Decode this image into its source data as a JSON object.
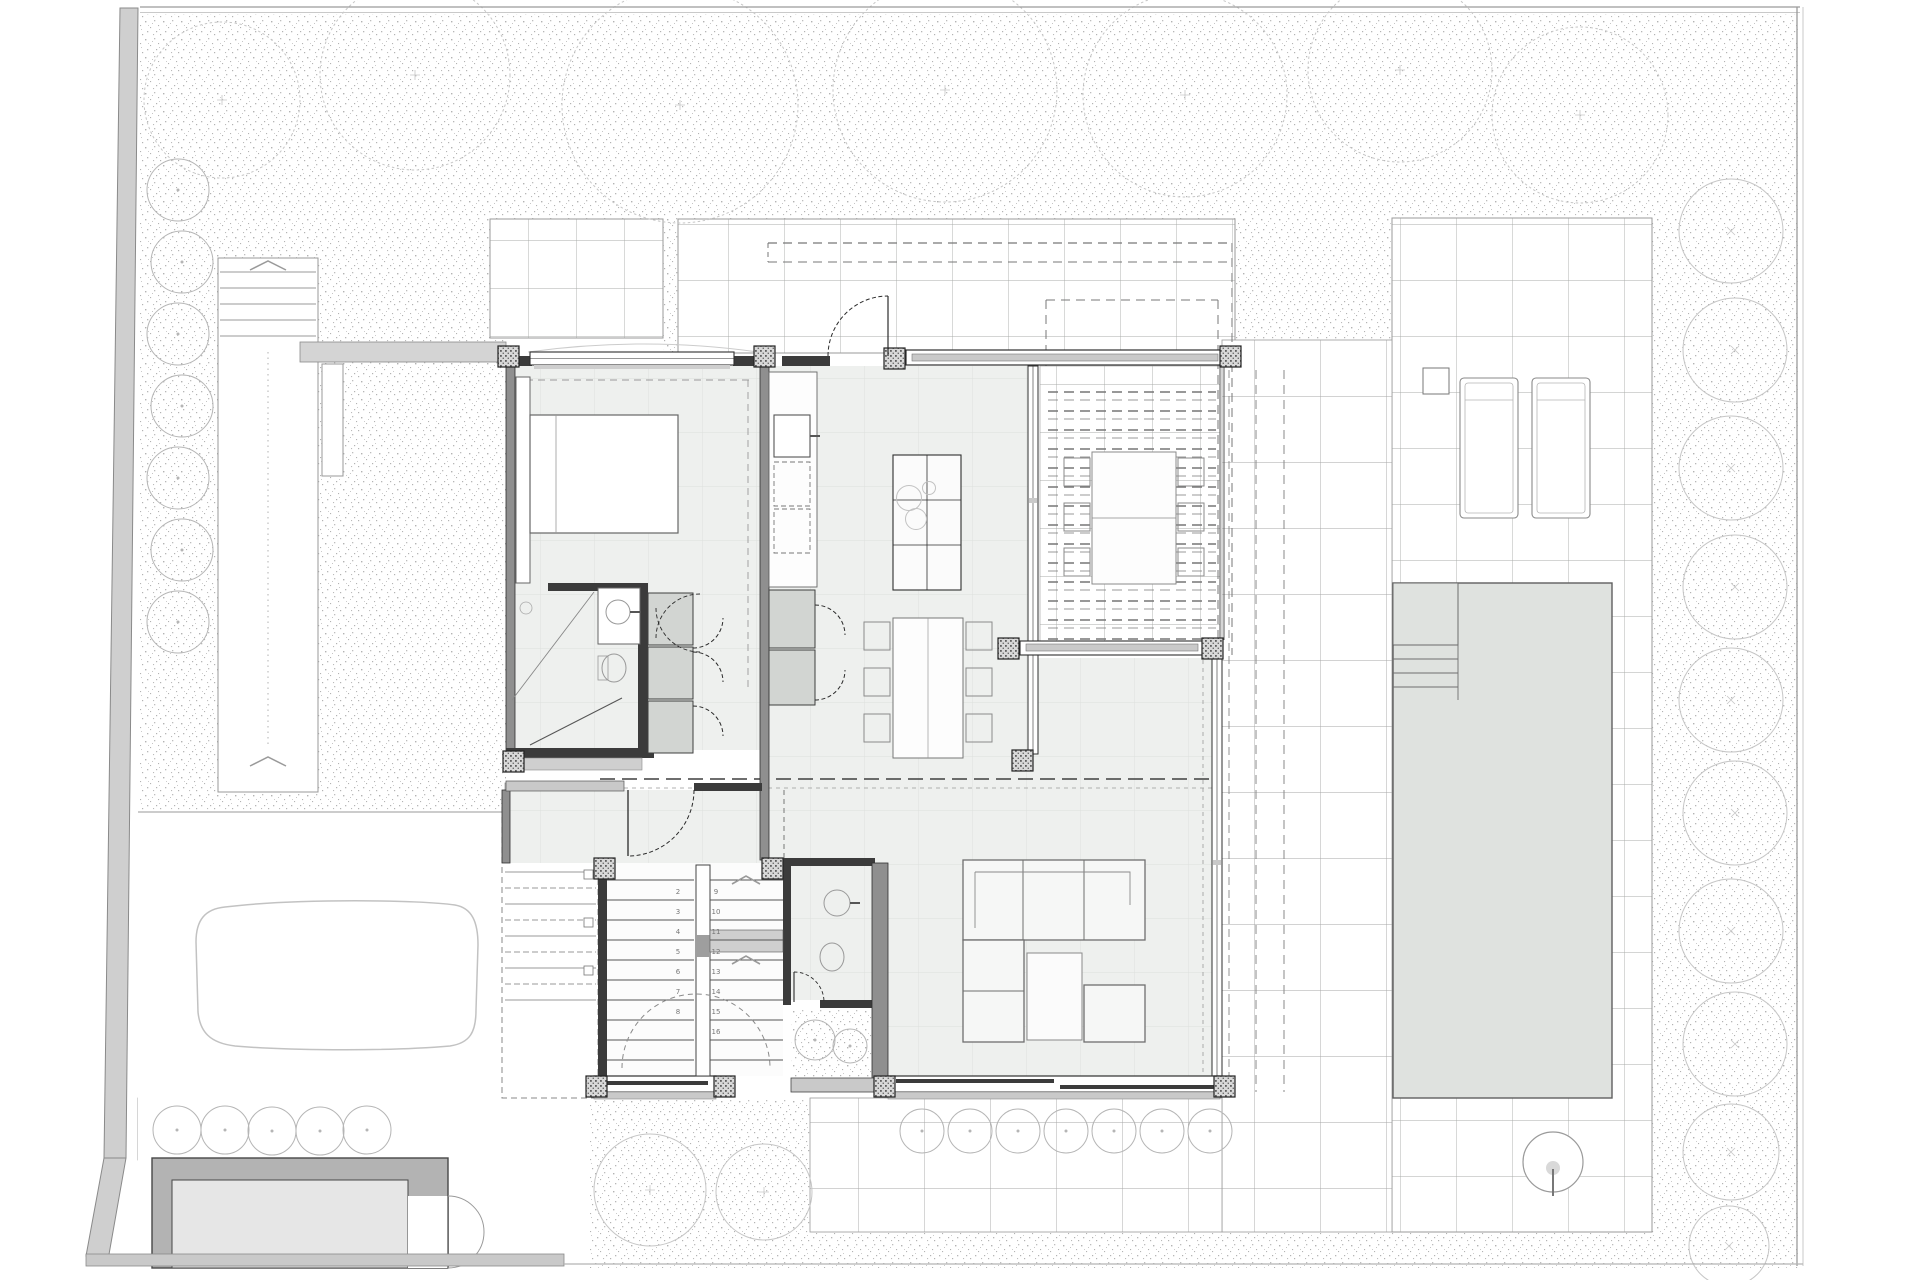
{
  "document": {
    "kind": "architectural-ground-floor-plan",
    "visible_text": "stair step numbers only"
  },
  "colors": {
    "paper": "#ffffff",
    "wall_dark": "#3b3b3b",
    "wall_medium": "#8f8f8f",
    "floor_fill": "#eef0ee",
    "floor_grid": "#dcdfdc",
    "tile_line": "#a8aba8",
    "stipple_dot": "#b3b3b3",
    "tree_outline": "#c6c6c6",
    "bush_outline": "#b5b5b5",
    "pool_fill": "#dfe2df",
    "pool_edge": "#5f5f5f",
    "casework_fill": "#d2d5d2",
    "casework_edge": "#3f3f3f",
    "glass_frame": "#2f2f2f",
    "sill_gray": "#c9c9c9",
    "dash_dark": "#3f3f3f",
    "dash_light": "#999999",
    "pergola_dash": "#777777",
    "boundary_fill": "#cfcfcf",
    "boundary_edge": "#8a8a8a",
    "car_outline": "#c2c2c2",
    "garage_wall": "#b3b3b3",
    "garage_floor": "#e6e6e6",
    "arrow_gray": "#9a9a9a",
    "furniture_edge": "#6f6f6f",
    "step_number": "#777777"
  },
  "landscape": {
    "canopy_trees": [
      {
        "cx": 222,
        "cy": 100,
        "r": 78
      },
      {
        "cx": 415,
        "cy": 75,
        "r": 95
      },
      {
        "cx": 680,
        "cy": 105,
        "r": 118
      },
      {
        "cx": 945,
        "cy": 90,
        "r": 112
      },
      {
        "cx": 1185,
        "cy": 95,
        "r": 102
      },
      {
        "cx": 1400,
        "cy": 70,
        "r": 92
      },
      {
        "cx": 1580,
        "cy": 115,
        "r": 88
      }
    ],
    "right_trees": [
      {
        "cx": 1731,
        "cy": 231,
        "r": 52
      },
      {
        "cx": 1735,
        "cy": 350,
        "r": 52
      },
      {
        "cx": 1731,
        "cy": 468,
        "r": 52
      },
      {
        "cx": 1735,
        "cy": 587,
        "r": 52
      },
      {
        "cx": 1731,
        "cy": 700,
        "r": 52
      },
      {
        "cx": 1735,
        "cy": 813,
        "r": 52
      },
      {
        "cx": 1731,
        "cy": 931,
        "r": 52
      },
      {
        "cx": 1735,
        "cy": 1044,
        "r": 52
      },
      {
        "cx": 1731,
        "cy": 1152,
        "r": 48
      },
      {
        "cx": 1729,
        "cy": 1246,
        "r": 40
      }
    ],
    "left_bushes": [
      {
        "cx": 178,
        "cy": 190,
        "r": 31
      },
      {
        "cx": 182,
        "cy": 262,
        "r": 31
      },
      {
        "cx": 178,
        "cy": 334,
        "r": 31
      },
      {
        "cx": 182,
        "cy": 406,
        "r": 31
      },
      {
        "cx": 178,
        "cy": 478,
        "r": 31
      },
      {
        "cx": 182,
        "cy": 550,
        "r": 31
      },
      {
        "cx": 178,
        "cy": 622,
        "r": 31
      }
    ],
    "sw_bushes": [
      {
        "cx": 177,
        "cy": 1130,
        "r": 24
      },
      {
        "cx": 225,
        "cy": 1130,
        "r": 24
      },
      {
        "cx": 272,
        "cy": 1131,
        "r": 24
      },
      {
        "cx": 320,
        "cy": 1131,
        "r": 24
      },
      {
        "cx": 367,
        "cy": 1130,
        "r": 24
      }
    ],
    "hedge_bushes": [
      {
        "cx": 922,
        "cy": 1131,
        "r": 22
      },
      {
        "cx": 970,
        "cy": 1131,
        "r": 22
      },
      {
        "cx": 1018,
        "cy": 1131,
        "r": 22
      },
      {
        "cx": 1066,
        "cy": 1131,
        "r": 22
      },
      {
        "cx": 1114,
        "cy": 1131,
        "r": 22
      },
      {
        "cx": 1162,
        "cy": 1131,
        "r": 22
      },
      {
        "cx": 1210,
        "cy": 1131,
        "r": 22
      }
    ],
    "bottom_trees": [
      {
        "cx": 650,
        "cy": 1190,
        "r": 56
      },
      {
        "cx": 764,
        "cy": 1192,
        "r": 48
      }
    ],
    "courtyard_bushes": [
      {
        "cx": 815,
        "cy": 1040,
        "r": 20
      },
      {
        "cx": 850,
        "cy": 1046,
        "r": 17
      }
    ]
  },
  "structure": {
    "column_size": 21,
    "columns": [
      [
        498,
        346
      ],
      [
        754,
        346
      ],
      [
        884,
        348
      ],
      [
        1220,
        346
      ],
      [
        1012,
        750
      ],
      [
        998,
        638
      ],
      [
        1202,
        638
      ],
      [
        594,
        858
      ],
      [
        762,
        858
      ],
      [
        586,
        1076
      ],
      [
        714,
        1076
      ],
      [
        874,
        1076
      ],
      [
        1214,
        1076
      ],
      [
        503,
        751
      ]
    ]
  },
  "pergola": {
    "slat_x1": 1048,
    "slat_x2": 1216,
    "slat_y_start": 392,
    "slat_y_end": 648,
    "slat_step": 19
  },
  "walkway": {
    "steps_x1": 220,
    "steps_x2": 316,
    "steps_y_start": 272,
    "steps_y_step": 16,
    "steps_count": 5
  },
  "ramp": {
    "treads_x1": 505,
    "treads_x2": 596,
    "treads_y_start": 808,
    "treads_y_step": 16,
    "treads_count": 13
  },
  "stairs": {
    "tread_y_start": 880,
    "tread_y_step": 20,
    "tread_count": 10,
    "left_x1": 607,
    "left_x2": 694,
    "right_x1": 710,
    "right_x2": 783,
    "left_numbers": [
      "2",
      "3",
      "4",
      "5",
      "6",
      "7",
      "8"
    ],
    "right_numbers": [
      "9",
      "10",
      "11",
      "12",
      "13",
      "14",
      "15",
      "16"
    ],
    "up_arrow_glyph": "^"
  }
}
